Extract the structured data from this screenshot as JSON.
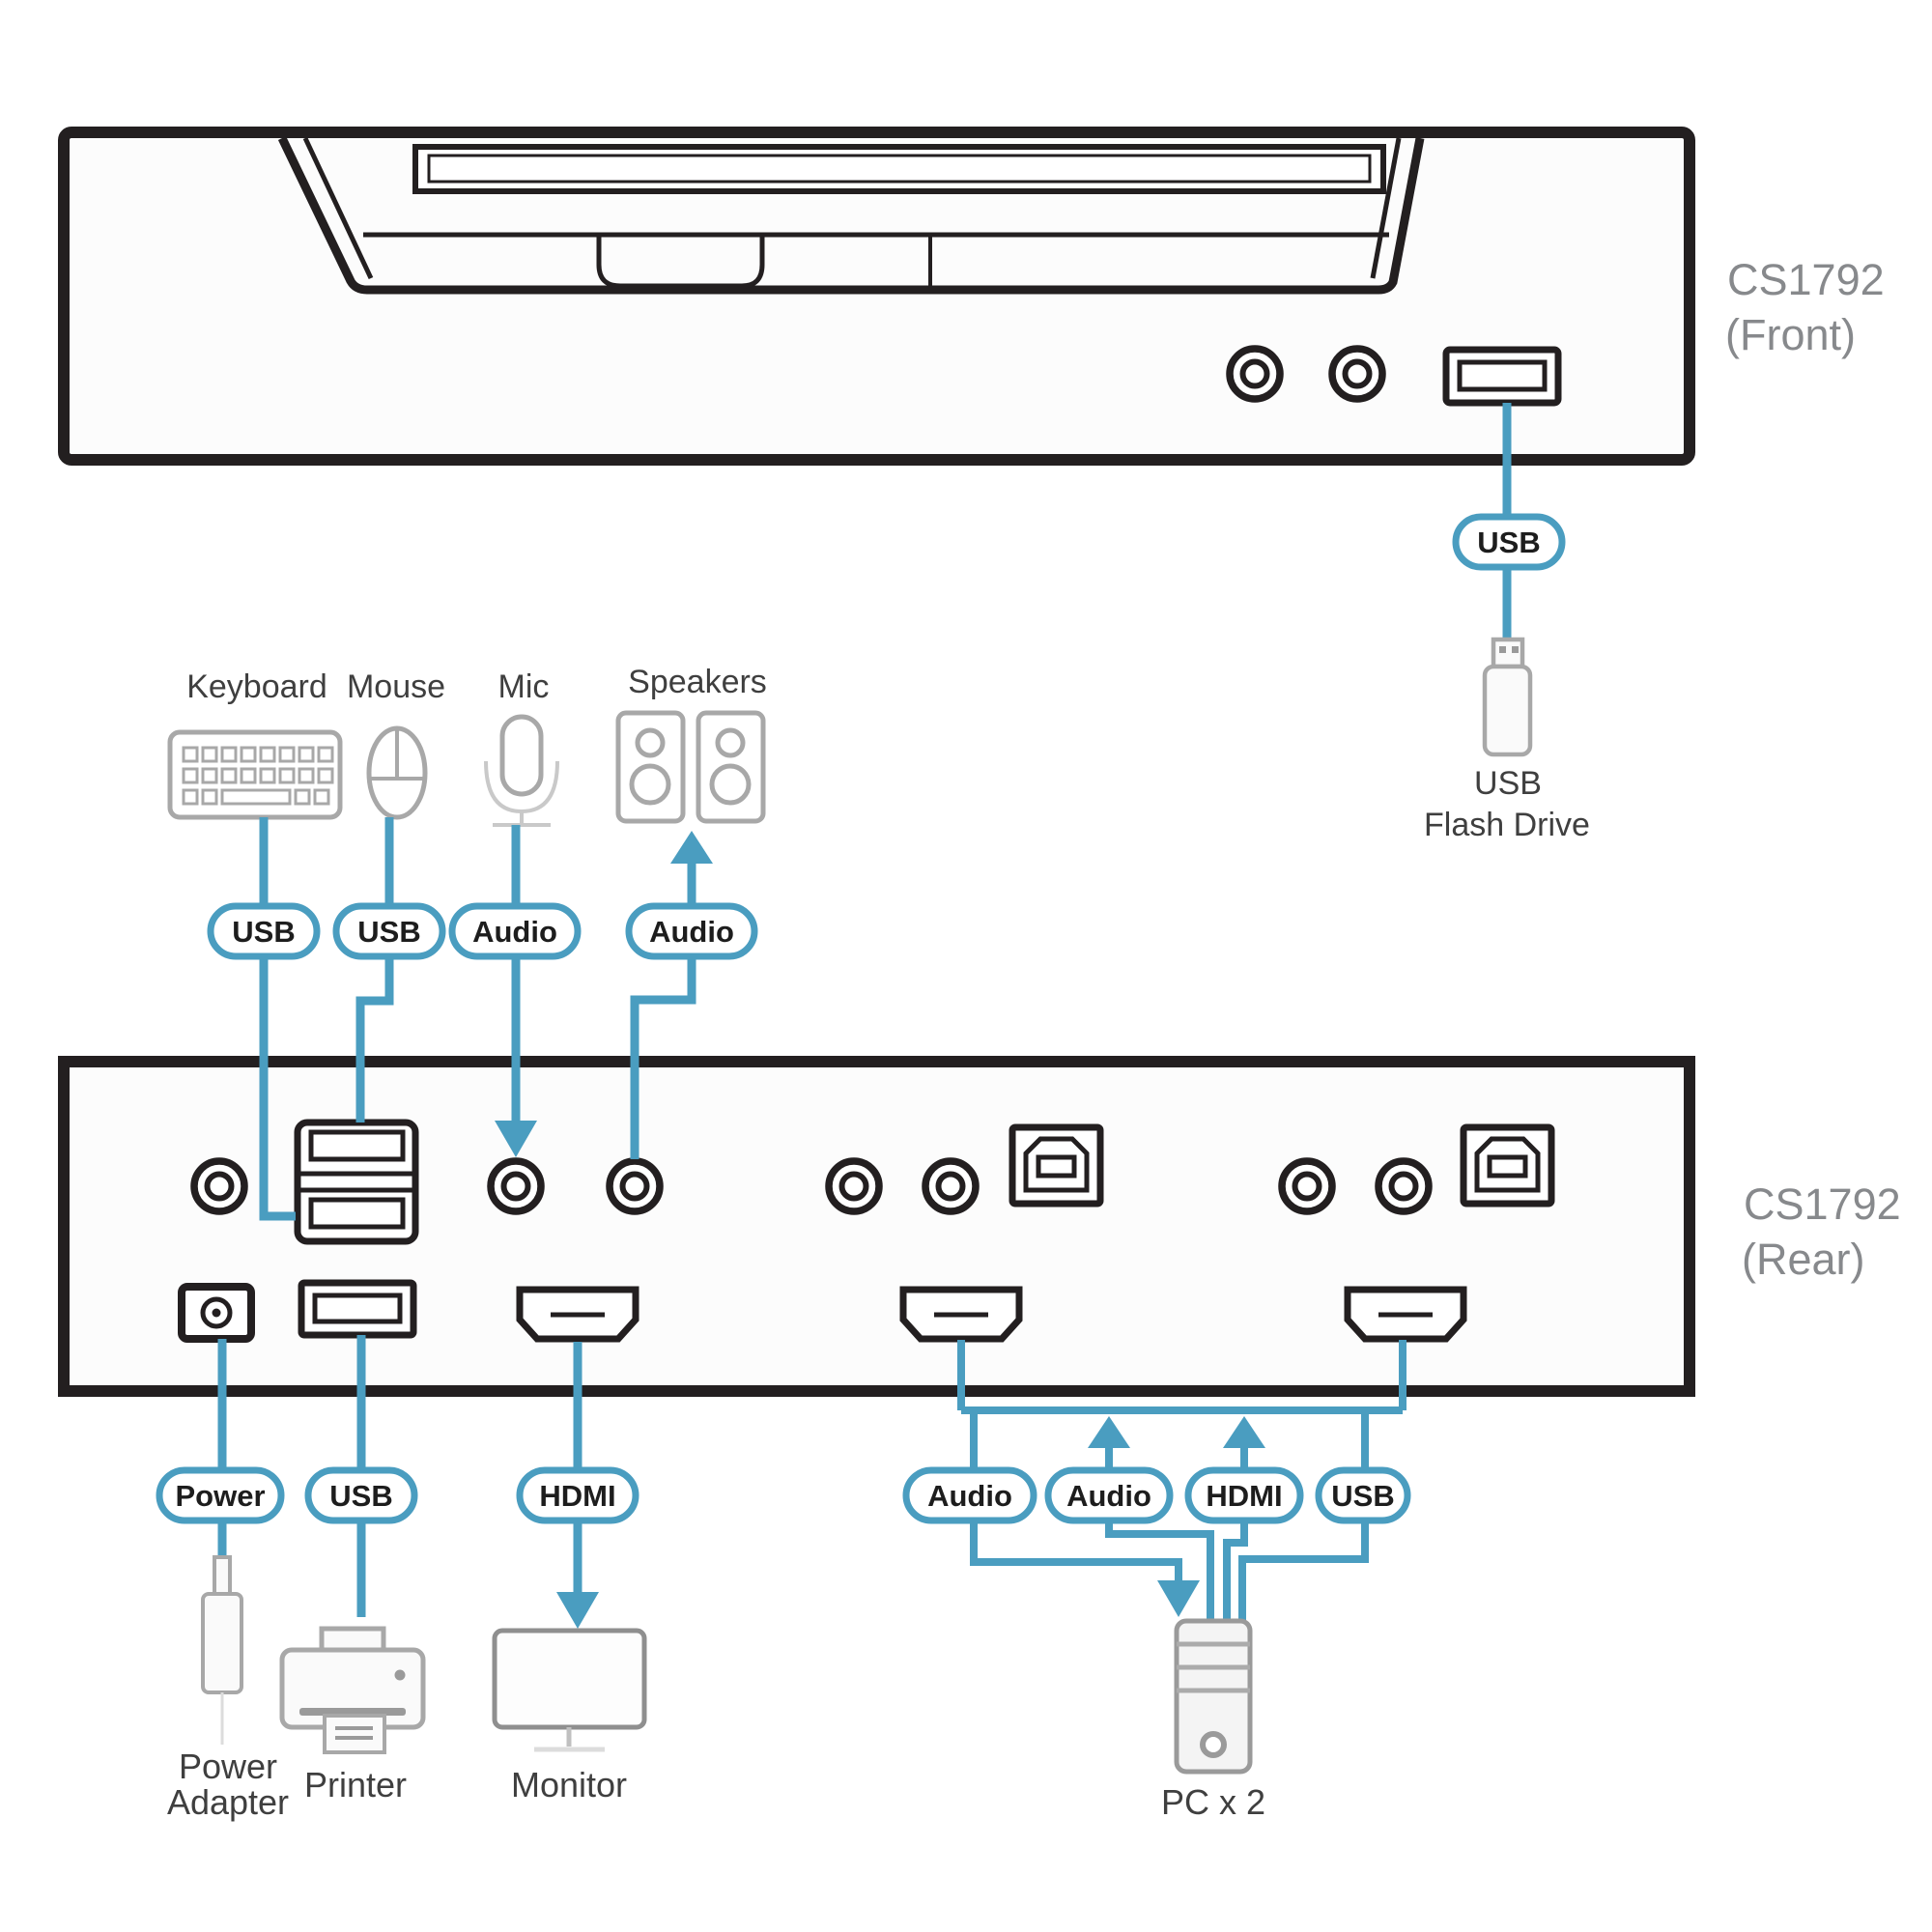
{
  "colors": {
    "accent_blue": "#4a9dc0",
    "outline_black": "#231f20",
    "icon_gray": "#a8a8a8",
    "model_label_gray": "#87898c",
    "text_dark": "#3f3f3f"
  },
  "front_panel": {
    "model": "CS1792",
    "view": "(Front)"
  },
  "rear_panel": {
    "model": "CS1792",
    "view": "(Rear)"
  },
  "front_usb": {
    "pill": "USB",
    "device_line1": "USB",
    "device_line2": "Flash Drive"
  },
  "console": {
    "keyboard": {
      "label": "Keyboard",
      "pill": "USB"
    },
    "mouse": {
      "label": "Mouse",
      "pill": "USB"
    },
    "mic": {
      "label": "Mic",
      "pill": "Audio"
    },
    "speakers": {
      "label": "Speakers",
      "pill": "Audio"
    }
  },
  "peripherals": {
    "power": {
      "pill": "Power",
      "label_line1": "Power",
      "label_line2": "Adapter"
    },
    "printer": {
      "pill": "USB",
      "label": "Printer"
    },
    "monitor": {
      "pill": "HDMI",
      "label": "Monitor"
    }
  },
  "pc": {
    "pills": {
      "audio1": "Audio",
      "audio2": "Audio",
      "hdmi": "HDMI",
      "usb": "USB"
    },
    "label": "PC x 2"
  }
}
